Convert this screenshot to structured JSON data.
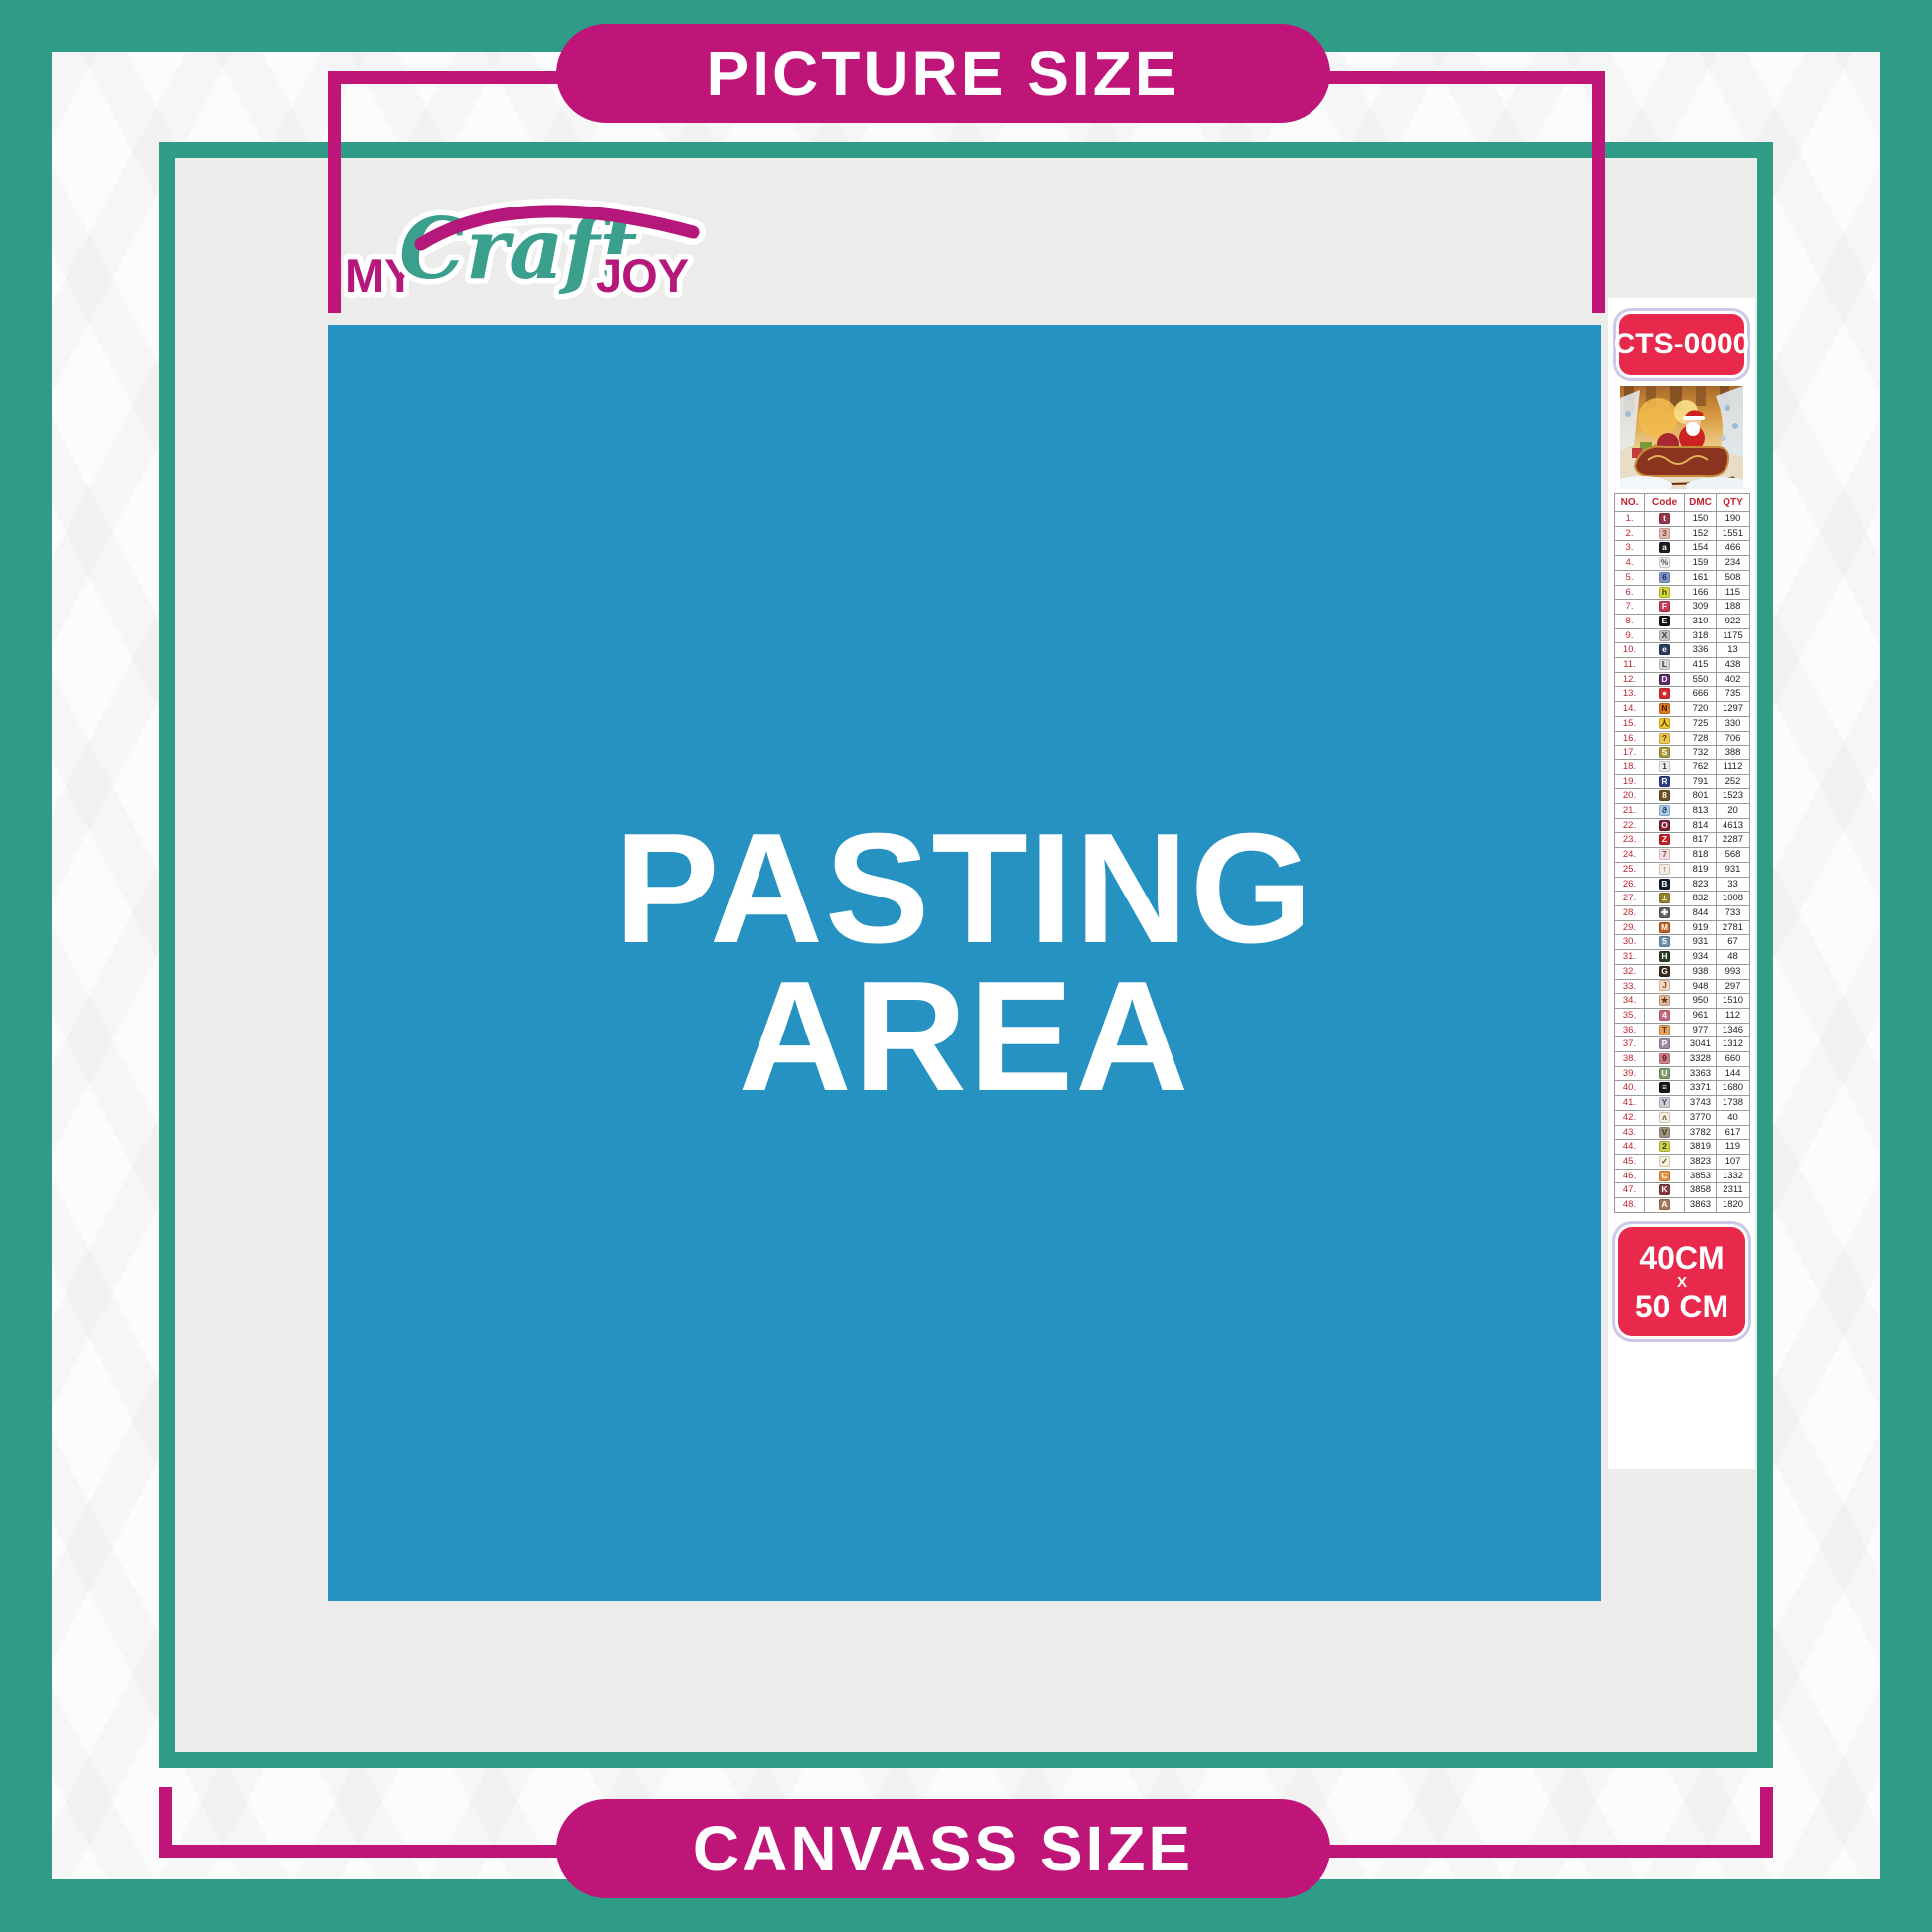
{
  "banners": {
    "top": "PICTURE SIZE",
    "bottom": "CANVASS SIZE"
  },
  "logo": {
    "my": "MY",
    "craft": "Craft",
    "joy": "JOY"
  },
  "pasting_area": {
    "line1": "PASTING",
    "line2": "AREA"
  },
  "sidebar": {
    "sku": "CTS-0000",
    "size": {
      "w": "40CM",
      "x": "X",
      "h": "50 CM"
    },
    "table": {
      "headers": [
        "NO.",
        "Code",
        "DMC",
        "QTY"
      ],
      "rows": [
        {
          "no": "1.",
          "sym": "t",
          "dmc": "150",
          "qty": "190",
          "bg": "#9a3548",
          "fg": "#ffffff"
        },
        {
          "no": "2.",
          "sym": "3",
          "dmc": "152",
          "qty": "1551",
          "bg": "#e5bab2",
          "fg": "#8c3a3a"
        },
        {
          "no": "3.",
          "sym": "a",
          "dmc": "154",
          "qty": "466",
          "bg": "#221820",
          "fg": "#ffffff"
        },
        {
          "no": "4.",
          "sym": "%",
          "dmc": "159",
          "qty": "234",
          "bg": "#f0eef2",
          "fg": "#55505a"
        },
        {
          "no": "5.",
          "sym": "6",
          "dmc": "161",
          "qty": "508",
          "bg": "#8395c6",
          "fg": "#1c2a60"
        },
        {
          "no": "6.",
          "sym": "h",
          "dmc": "166",
          "qty": "115",
          "bg": "#d8d832",
          "fg": "#3c3c10"
        },
        {
          "no": "7.",
          "sym": "F",
          "dmc": "309",
          "qty": "188",
          "bg": "#cb3a57",
          "fg": "#ffffff"
        },
        {
          "no": "8.",
          "sym": "E",
          "dmc": "310",
          "qty": "922",
          "bg": "#141414",
          "fg": "#ffffff"
        },
        {
          "no": "9.",
          "sym": "X",
          "dmc": "318",
          "qty": "1175",
          "bg": "#c3c3c8",
          "fg": "#3a3a3a"
        },
        {
          "no": "10.",
          "sym": "e",
          "dmc": "336",
          "qty": "13",
          "bg": "#2a3a60",
          "fg": "#ffffff"
        },
        {
          "no": "11.",
          "sym": "L",
          "dmc": "415",
          "qty": "438",
          "bg": "#d6d6da",
          "fg": "#3a3a3a"
        },
        {
          "no": "12.",
          "sym": "D",
          "dmc": "550",
          "qty": "402",
          "bg": "#5c2868",
          "fg": "#ffffff"
        },
        {
          "no": "13.",
          "sym": "●",
          "dmc": "666",
          "qty": "735",
          "bg": "#d62c2c",
          "fg": "#ffffff"
        },
        {
          "no": "14.",
          "sym": "N",
          "dmc": "720",
          "qty": "1297",
          "bg": "#e2761c",
          "fg": "#3a1c00"
        },
        {
          "no": "15.",
          "sym": "人",
          "dmc": "725",
          "qty": "330",
          "bg": "#f0c82e",
          "fg": "#4a3800"
        },
        {
          "no": "16.",
          "sym": "?",
          "dmc": "728",
          "qty": "706",
          "bg": "#ecc94e",
          "fg": "#4a3800"
        },
        {
          "no": "17.",
          "sym": "S",
          "dmc": "732",
          "qty": "388",
          "bg": "#a9973a",
          "fg": "#ffffff"
        },
        {
          "no": "18.",
          "sym": "1",
          "dmc": "762",
          "qty": "1112",
          "bg": "#eeeef0",
          "fg": "#3a3a3a"
        },
        {
          "no": "19.",
          "sym": "R",
          "dmc": "791",
          "qty": "252",
          "bg": "#2c3f8a",
          "fg": "#ffffff"
        },
        {
          "no": "20.",
          "sym": "8",
          "dmc": "801",
          "qty": "1523",
          "bg": "#6d531f",
          "fg": "#ffffff"
        },
        {
          "no": "21.",
          "sym": "ϑ",
          "dmc": "813",
          "qty": "20",
          "bg": "#a9cbe6",
          "fg": "#1c3a6a"
        },
        {
          "no": "22.",
          "sym": "O",
          "dmc": "814",
          "qty": "4613",
          "bg": "#7e2230",
          "fg": "#ffffff"
        },
        {
          "no": "23.",
          "sym": "Z",
          "dmc": "817",
          "qty": "2287",
          "bg": "#c42029",
          "fg": "#ffffff"
        },
        {
          "no": "24.",
          "sym": "7",
          "dmc": "818",
          "qty": "568",
          "bg": "#f6e0e0",
          "fg": "#8a4a4a"
        },
        {
          "no": "25.",
          "sym": "↑",
          "dmc": "819",
          "qty": "931",
          "bg": "#f4ece2",
          "fg": "#5a5248"
        },
        {
          "no": "26.",
          "sym": "B",
          "dmc": "823",
          "qty": "33",
          "bg": "#131b33",
          "fg": "#ffffff"
        },
        {
          "no": "27.",
          "sym": "±",
          "dmc": "832",
          "qty": "1008",
          "bg": "#94822c",
          "fg": "#ffffff"
        },
        {
          "no": "28.",
          "sym": "✤",
          "dmc": "844",
          "qty": "733",
          "bg": "#616165",
          "fg": "#ffffff"
        },
        {
          "no": "29.",
          "sym": "M",
          "dmc": "919",
          "qty": "2781",
          "bg": "#c45d1f",
          "fg": "#ffffff"
        },
        {
          "no": "30.",
          "sym": "5",
          "dmc": "931",
          "qty": "67",
          "bg": "#7390ab",
          "fg": "#ffffff"
        },
        {
          "no": "31.",
          "sym": "H",
          "dmc": "934",
          "qty": "48",
          "bg": "#2e3a2a",
          "fg": "#ffffff"
        },
        {
          "no": "32.",
          "sym": "G",
          "dmc": "938",
          "qty": "993",
          "bg": "#3c2b19",
          "fg": "#ffffff"
        },
        {
          "no": "33.",
          "sym": "J",
          "dmc": "948",
          "qty": "297",
          "bg": "#f6d9c2",
          "fg": "#8a4a2a"
        },
        {
          "no": "34.",
          "sym": "★",
          "dmc": "950",
          "qty": "1510",
          "bg": "#e4b99c",
          "fg": "#6a3a1c"
        },
        {
          "no": "35.",
          "sym": "4",
          "dmc": "961",
          "qty": "112",
          "bg": "#c66b7e",
          "fg": "#ffffff"
        },
        {
          "no": "36.",
          "sym": "T",
          "dmc": "977",
          "qty": "1346",
          "bg": "#e4a45a",
          "fg": "#5a3410"
        },
        {
          "no": "37.",
          "sym": "P",
          "dmc": "3041",
          "qty": "1312",
          "bg": "#9b8ca0",
          "fg": "#ffffff"
        },
        {
          "no": "38.",
          "sym": "9",
          "dmc": "3328",
          "qty": "660",
          "bg": "#cb8187",
          "fg": "#5c1018"
        },
        {
          "no": "39.",
          "sym": "U",
          "dmc": "3363",
          "qty": "144",
          "bg": "#7d9c6c",
          "fg": "#ffffff"
        },
        {
          "no": "40.",
          "sym": "≡",
          "dmc": "3371",
          "qty": "1680",
          "bg": "#1b140f",
          "fg": "#ffffff"
        },
        {
          "no": "41.",
          "sym": "Y",
          "dmc": "3743",
          "qty": "1738",
          "bg": "#cfccda",
          "fg": "#4a4a5c"
        },
        {
          "no": "42.",
          "sym": "ʌ",
          "dmc": "3770",
          "qty": "40",
          "bg": "#f6eede",
          "fg": "#6a5c3c"
        },
        {
          "no": "43.",
          "sym": "V",
          "dmc": "3782",
          "qty": "617",
          "bg": "#a29382",
          "fg": "#3c3020"
        },
        {
          "no": "44.",
          "sym": "2",
          "dmc": "3819",
          "qty": "119",
          "bg": "#ced24c",
          "fg": "#3a3a08"
        },
        {
          "no": "45.",
          "sym": "✓",
          "dmc": "3823",
          "qty": "107",
          "bg": "#f8f0da",
          "fg": "#5a5a2a"
        },
        {
          "no": "46.",
          "sym": "C",
          "dmc": "3853",
          "qty": "1332",
          "bg": "#e4933e",
          "fg": "#ffffff"
        },
        {
          "no": "47.",
          "sym": "K",
          "dmc": "3858",
          "qty": "2311",
          "bg": "#853a40",
          "fg": "#ffffff"
        },
        {
          "no": "48.",
          "sym": "A",
          "dmc": "3863",
          "qty": "1820",
          "bg": "#a57b5e",
          "fg": "#ffffff"
        }
      ]
    }
  },
  "colors": {
    "teal": "#2E9C86",
    "magenta": "#C01578",
    "logo_magenta": "#B5177A",
    "logo_teal": "#3AA08D",
    "blue": "#2592C2",
    "badge_red": "#E8294C",
    "table_red": "#C4232E",
    "interior_gray": "#ECECEA"
  }
}
